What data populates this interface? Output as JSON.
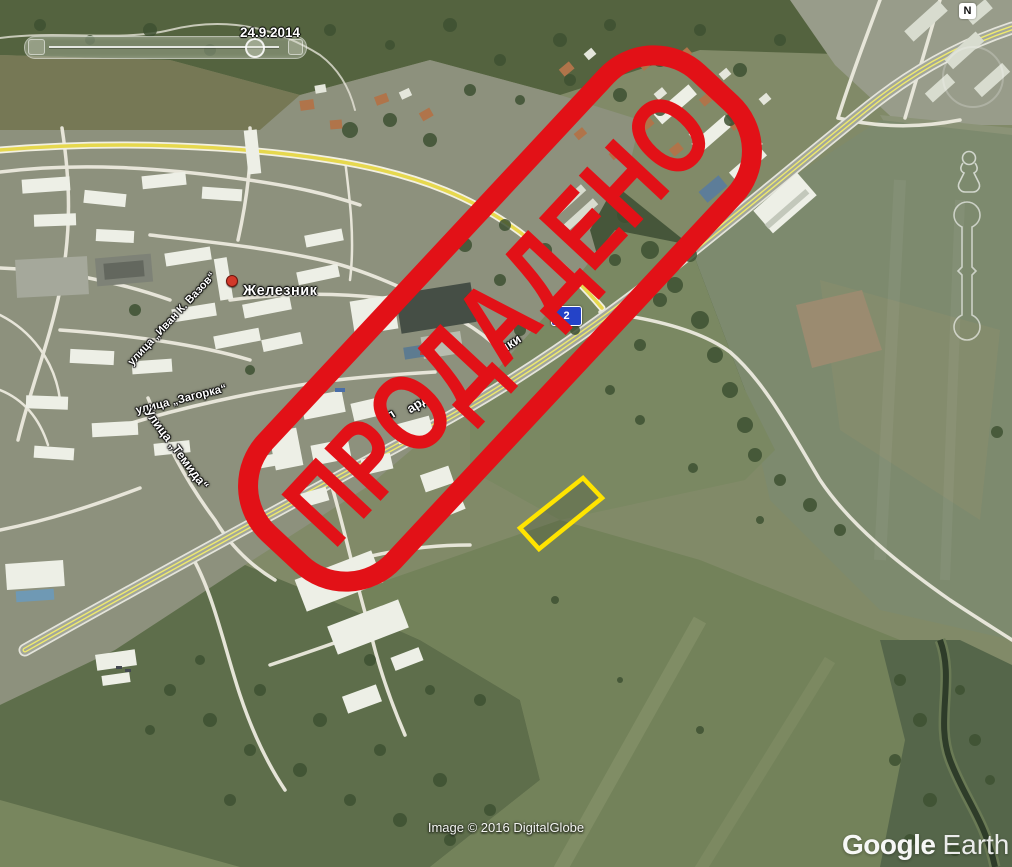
{
  "stamp": {
    "text": "ПРОДАДЕНО",
    "color": "#e21117"
  },
  "map": {
    "place_label": "Железник",
    "route_shield": "2",
    "streets": [
      {
        "text": "улица „Иван К. Вазов“"
      },
      {
        "text": "улица „Загорка“"
      },
      {
        "text": "Улица „Темида“"
      }
    ],
    "road_fragments": [
      "л",
      "ард",
      "ики"
    ],
    "parcel_outline_color": "#ffe400"
  },
  "controls": {
    "compass_n": "N",
    "time_slider": {
      "date": "24.9.2014"
    }
  },
  "attribution": {
    "imagery_credit": "Image © 2016 DigitalGlobe",
    "logo": {
      "google": "Google",
      "earth": "Earth"
    }
  }
}
